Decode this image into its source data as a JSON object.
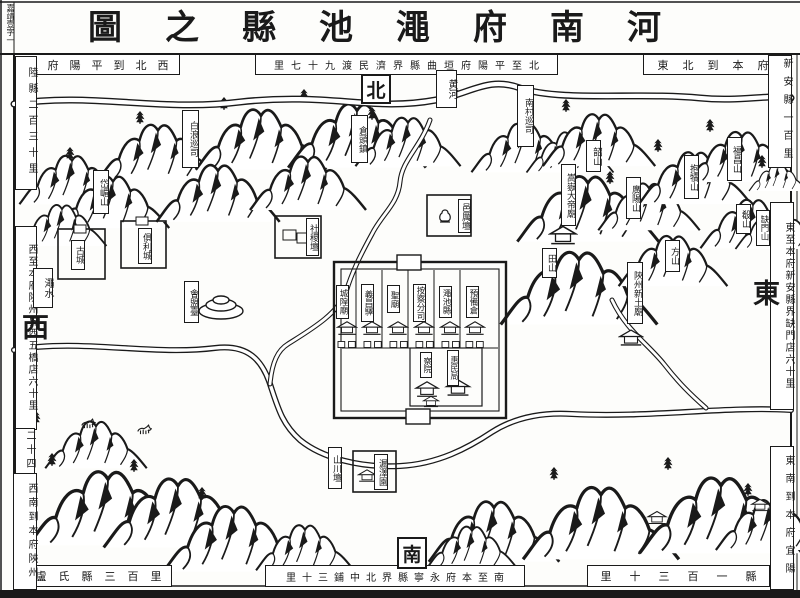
{
  "page": {
    "corner_mark": "嘉靖壹字一"
  },
  "title": "河南府澠池縣之圖",
  "compass": {
    "north": "北",
    "south": "南",
    "east": "東",
    "west": "西"
  },
  "border_notes": {
    "top_left": "西北到平陽府平",
    "left_top": "陸縣二百三十里",
    "top_center": "北至平陽府垣曲縣界濟民渡九十七里",
    "top_right": "東北到本府",
    "right_top": "新安縣一百里",
    "right_middle": "東至本府新安縣界缺門店六十里",
    "right_bottom": "東南到本府宜陽",
    "bottom_right": "縣一百三十里",
    "bottom_center": "南至本府永寧縣界北中鋪三十里",
    "bottom_left": "盧氏縣三百里",
    "left_middle": "西至本府陝州界西五橋店六十里",
    "left_small": "二十四",
    "left_bottom": "西南到本府陝州"
  },
  "rivers": {
    "yellow_river": "黄河",
    "mian_river": "澠水"
  },
  "places": {
    "bailang_xunsi": "白浪巡司",
    "cangtou_zhen": "倉頭鎮",
    "nancun_xunsi": "南村巡司",
    "daimei_shan": "岱嵋山",
    "gu_cheng": "古城",
    "juli_cheng": "俱利城",
    "huimeng_tai": "會盟臺",
    "sheji_tan": "社稷壇",
    "yili_tan": "邑厲壇",
    "shao_shan": "韶山",
    "songyue_dadi_miao": "嵩嶽大帝廟",
    "tian_shan": "田山",
    "guangyang_shan": "廣陽山",
    "baodu_shan": "抱犢山",
    "fuchang_shan": "福昌山",
    "xiao_shan": "殽山",
    "fang_shan": "方山",
    "shanzhou_xintu_miao": "陝州新土廟",
    "quemen_shan": "缺門山",
    "shanchuan_tan": "山川壇",
    "louze_yuan": "漏澤園"
  },
  "city": {
    "buildings": [
      "城隍廟",
      "義昌驛",
      "聖廟",
      "按察分司",
      "澠池縣",
      "預備倉"
    ],
    "annex_buildings": [
      "察院",
      "惠民局"
    ]
  }
}
